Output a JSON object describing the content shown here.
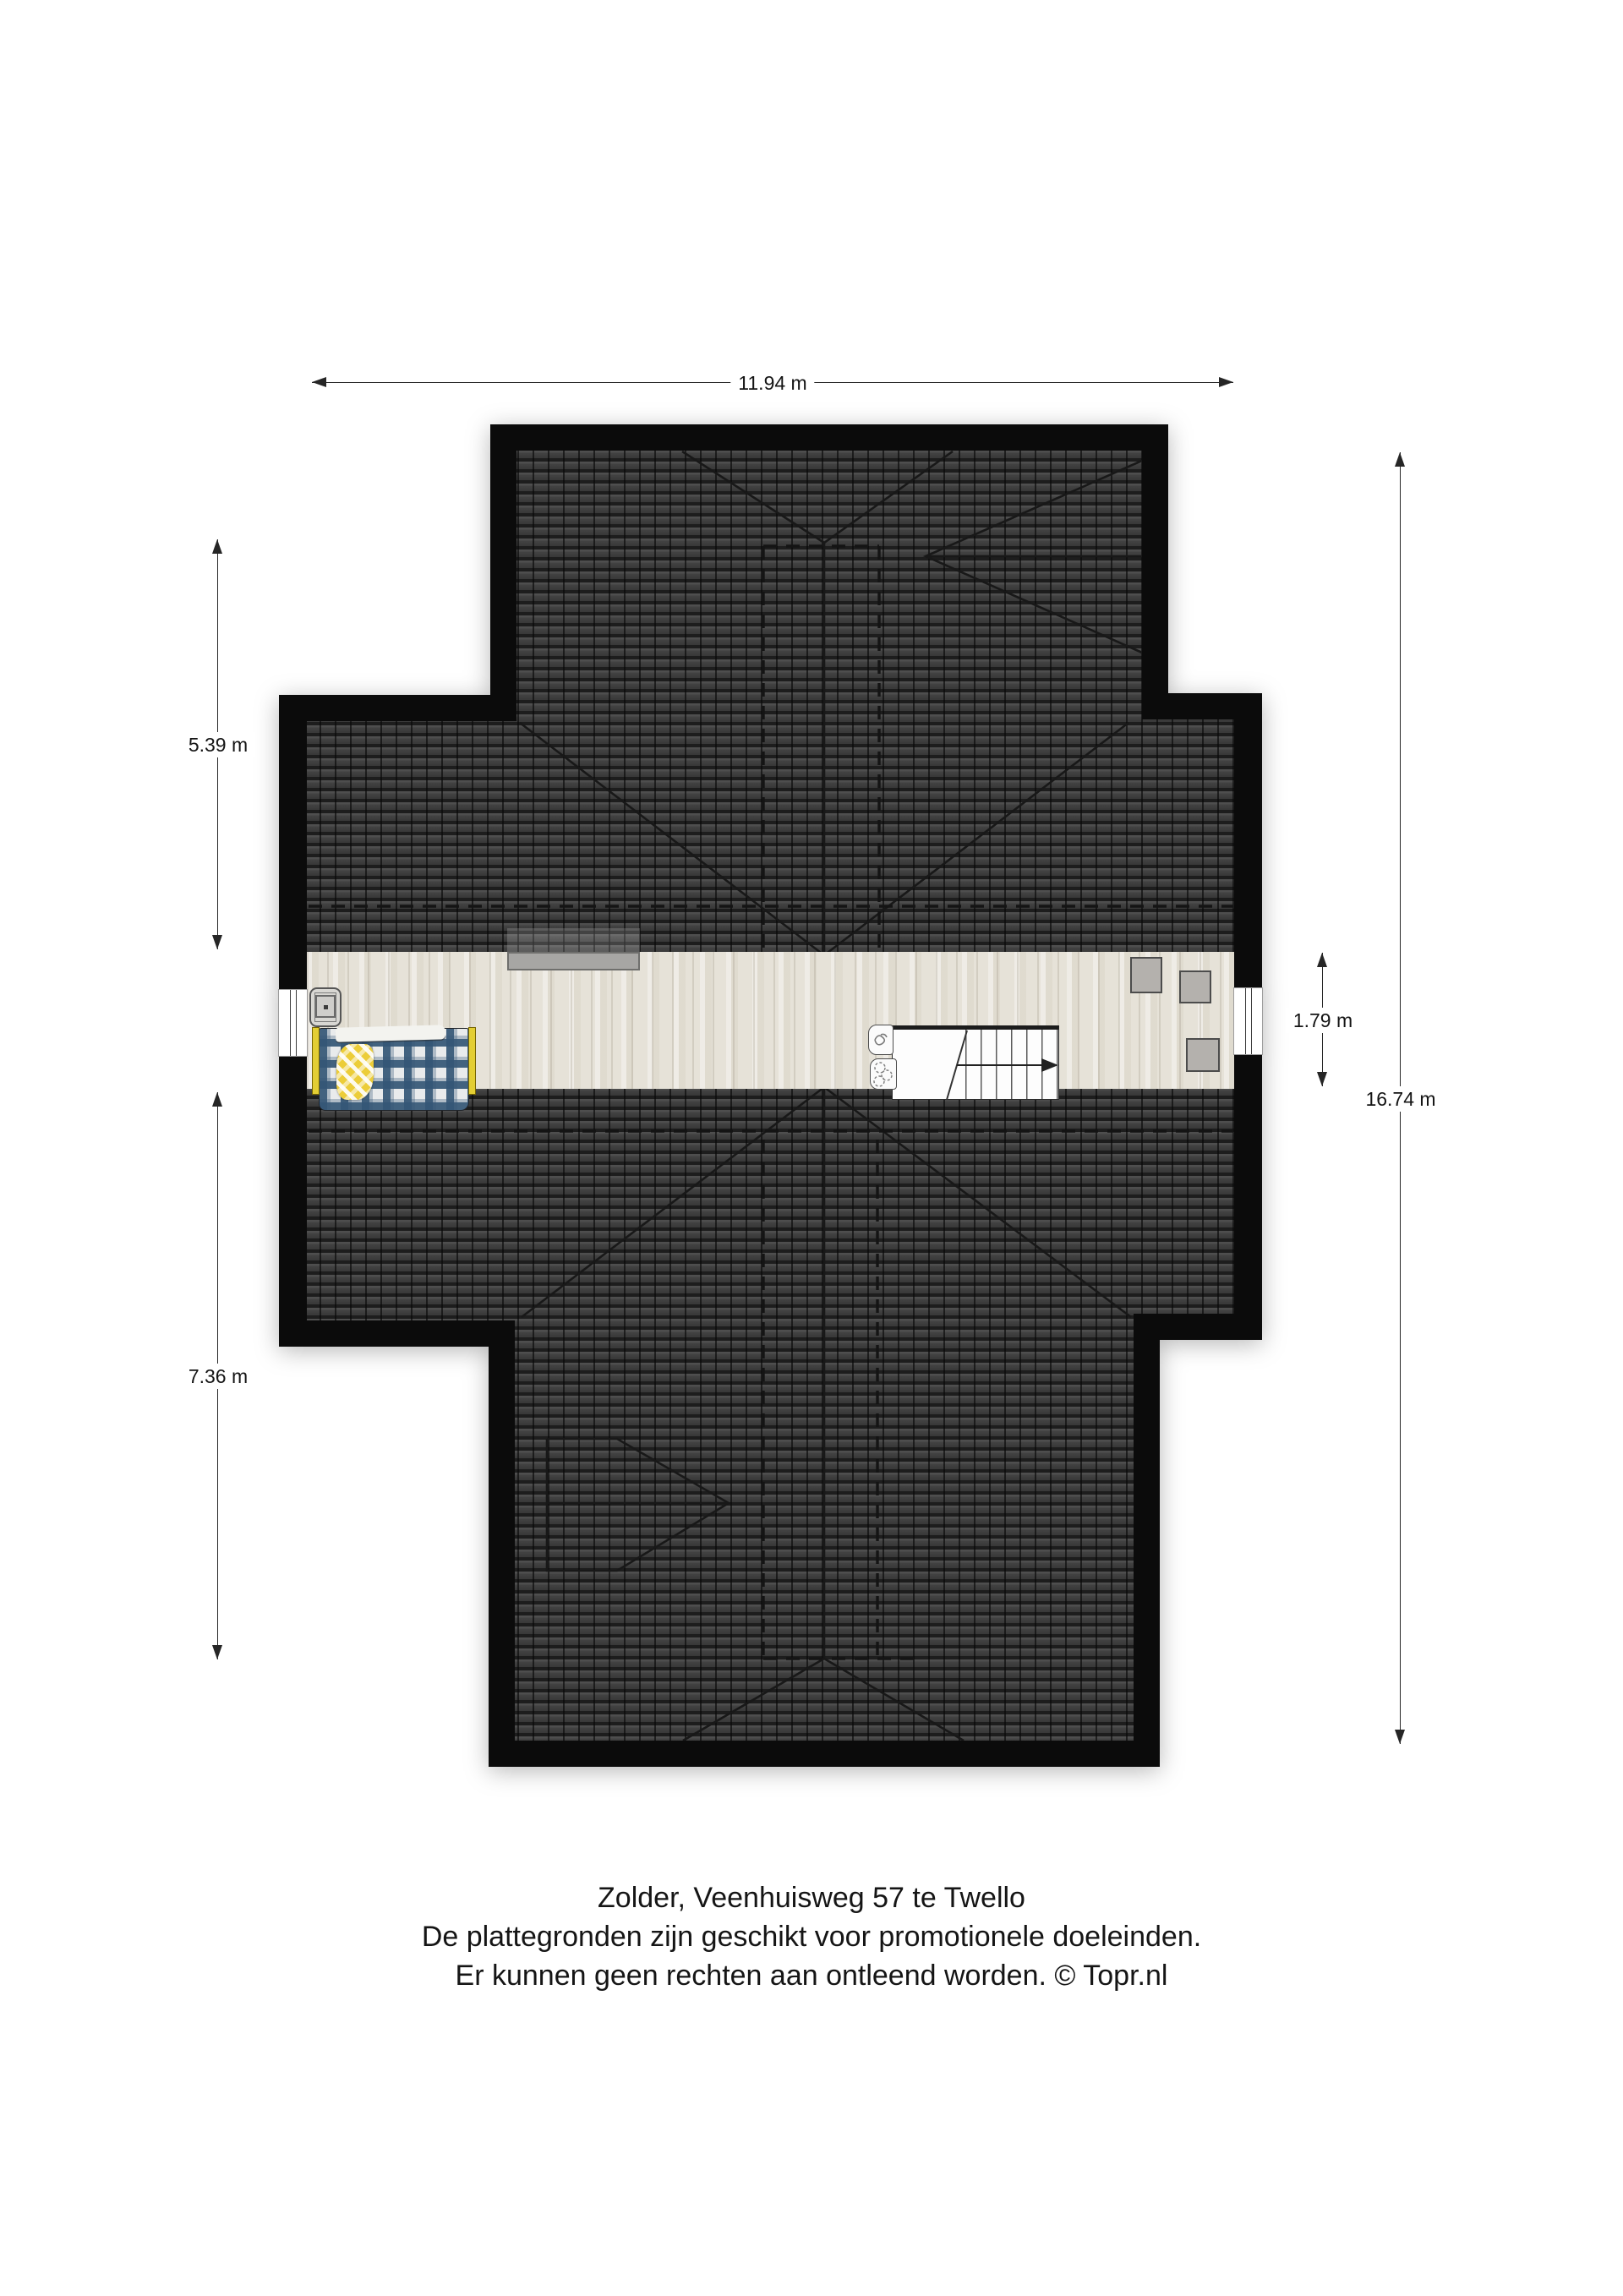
{
  "document": {
    "type": "floorplan",
    "floor_name": "Zolder",
    "address": "Veenhuisweg 57 te Twello"
  },
  "dimensions": {
    "top_width": {
      "label": "11.94 m"
    },
    "left_upper": {
      "label": "5.39 m"
    },
    "left_lower": {
      "label": "7.36 m"
    },
    "corridor": {
      "label": "1.79 m"
    },
    "total_right": {
      "label": "16.74 m"
    }
  },
  "caption": {
    "lines": [
      "Zolder, Veenhuisweg 57 te Twello",
      "De plattegronden zijn geschikt voor promotionele doeleinden.",
      "Er kunnen geen rechten aan ontleend worden. © Topr.nl"
    ]
  },
  "scene": {
    "rooms": [
      {
        "name": "attic-corridor",
        "floor": "light-wood"
      }
    ],
    "furniture": [
      "bed-with-plaid-blanket",
      "nightstand",
      "wall-shelf",
      "staircase-down",
      "sanitary-fixture",
      "sanitary-fixture",
      "storage-box",
      "storage-box",
      "storage-box",
      "window-left",
      "window-right"
    ],
    "colors": {
      "wall": "#0b0b0b",
      "roof_tiles": "#3c3c3c",
      "floor": "#e6e2d8",
      "blanket_plaid": "#345676",
      "bed_frame": "#e3ce34",
      "blanket_fold": "#eccd39",
      "storage_gray": "#b4b1ad",
      "shelf_gray": "#a7a6a4"
    }
  }
}
